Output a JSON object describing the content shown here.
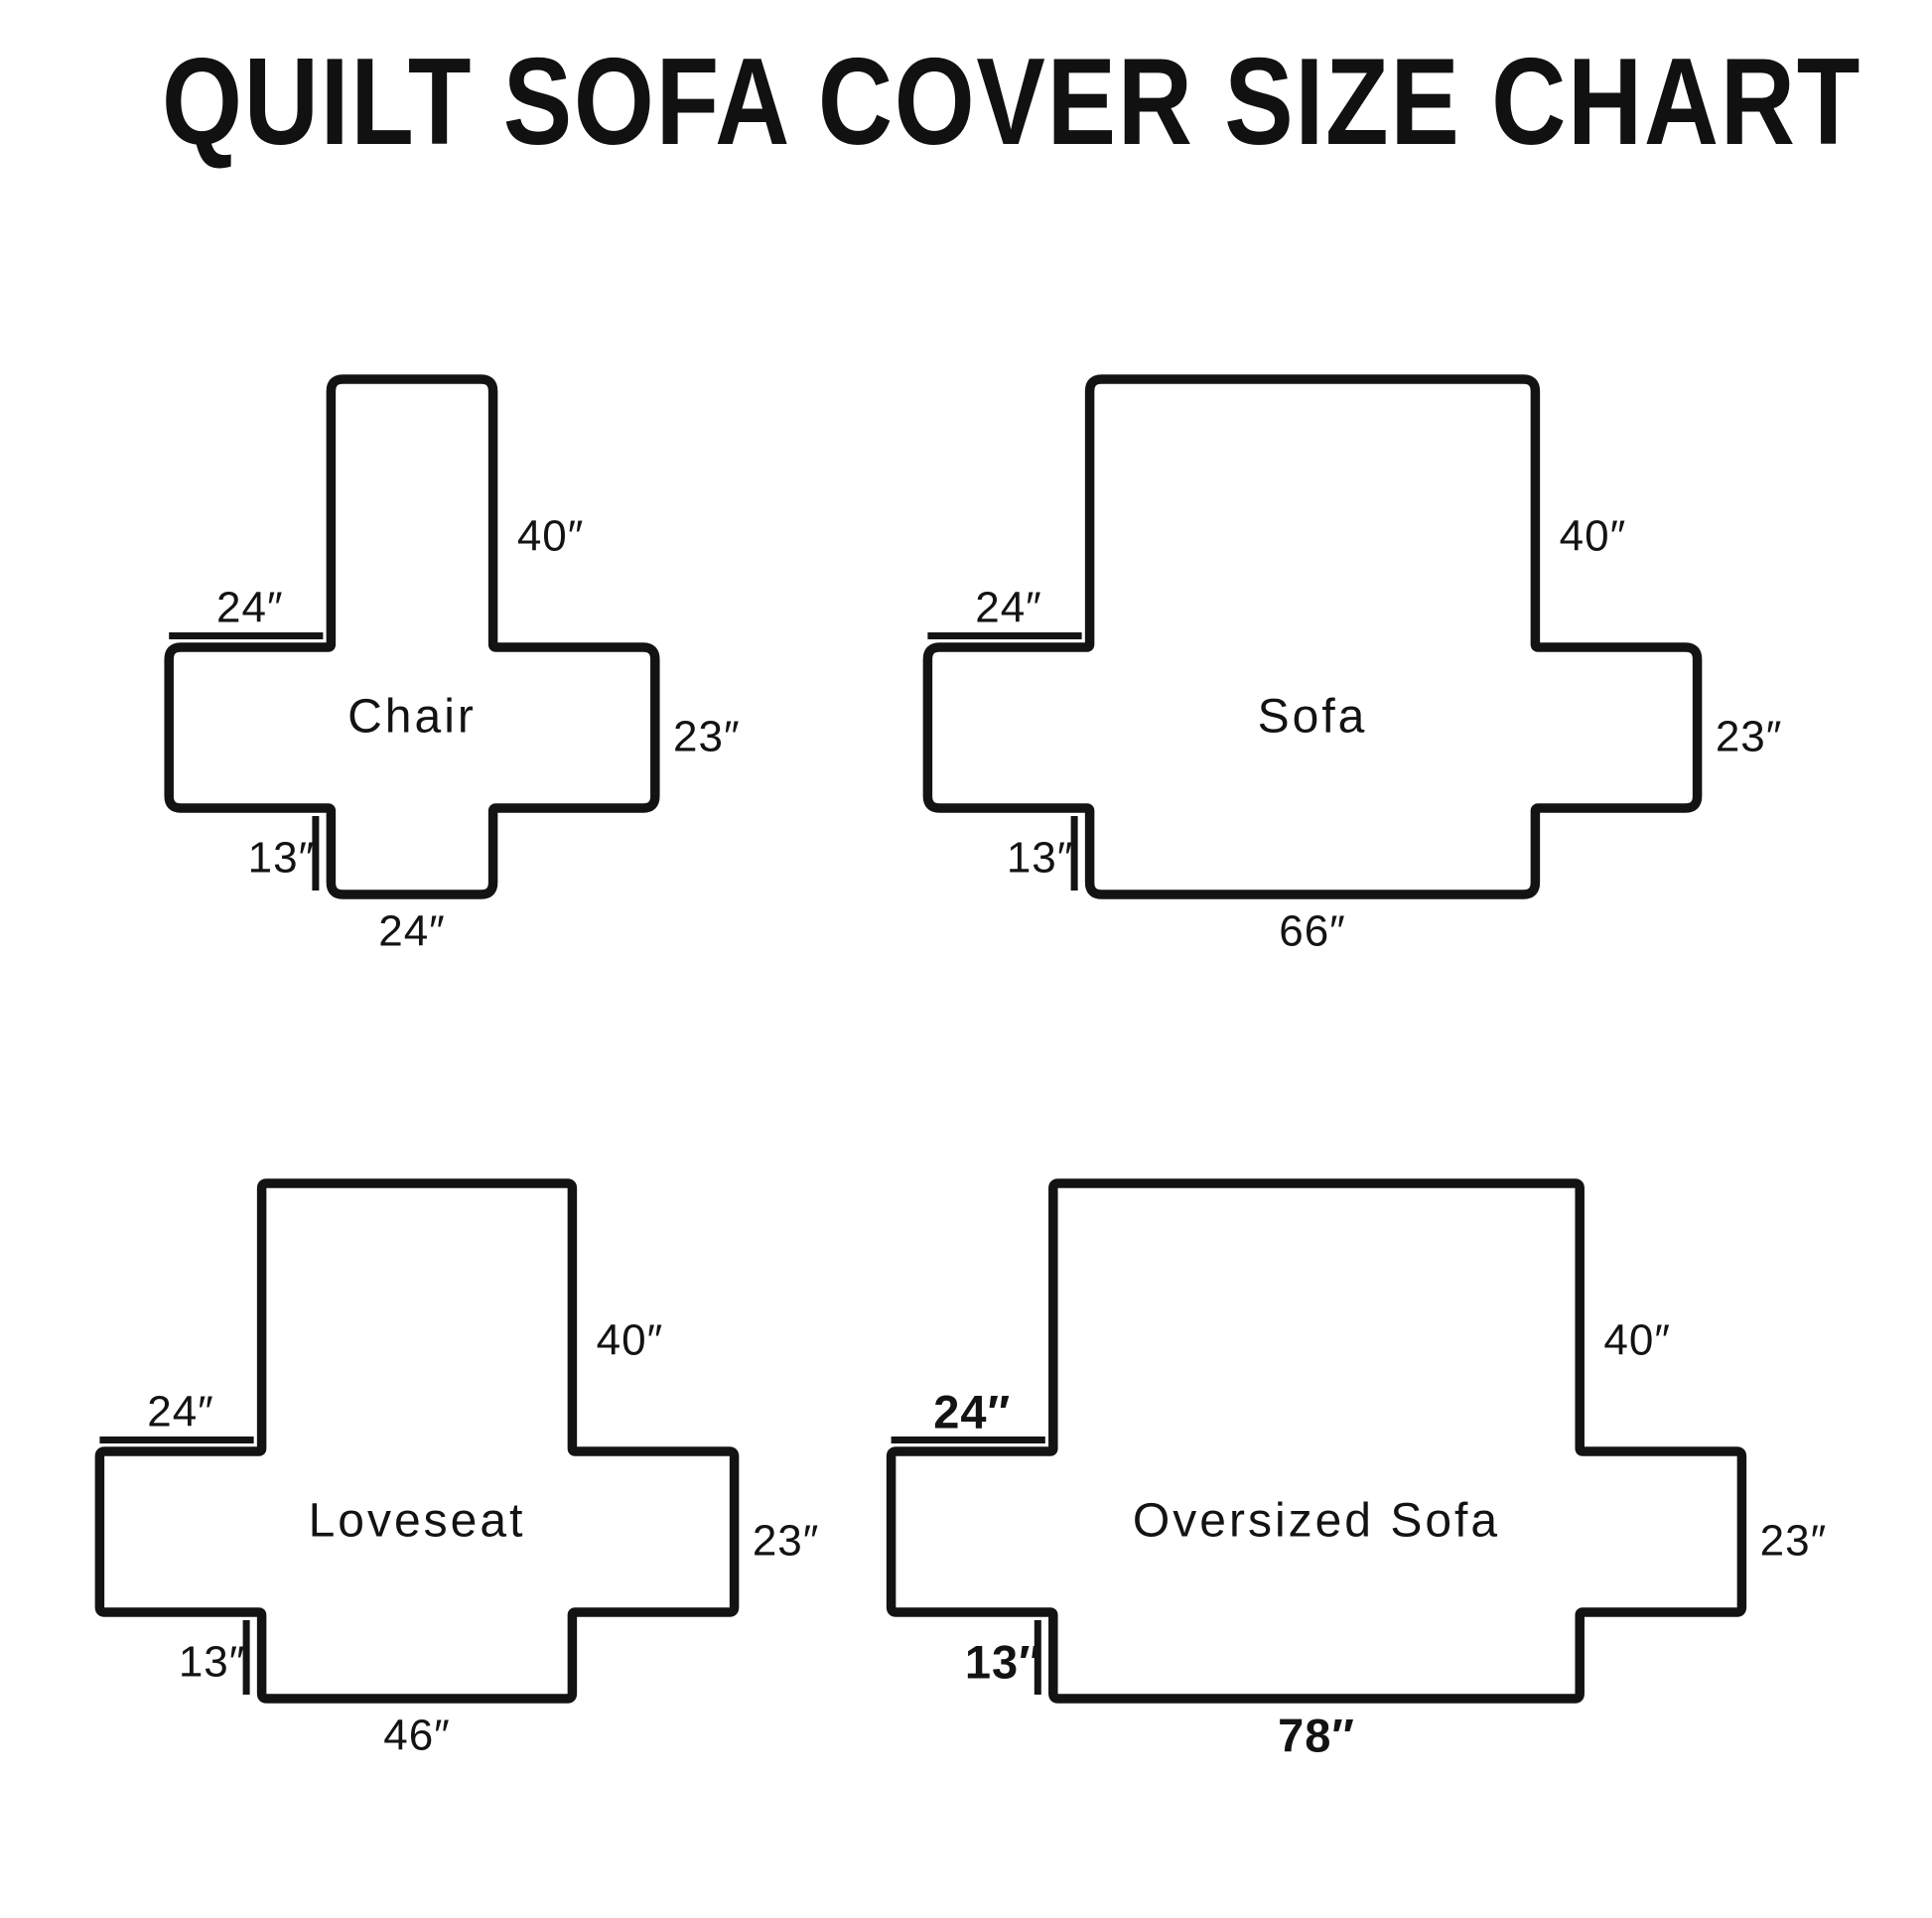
{
  "title": "QUILT SOFA COVER SIZE CHART",
  "unit_mark": "″",
  "colors": {
    "ink": "#131313",
    "background": "#ffffff"
  },
  "diagrams": [
    {
      "id": "chair",
      "name": "Chair",
      "back_height_label": "40″",
      "arm_depth_label": "24″",
      "arm_height_label": "23″",
      "flap_height_label": "13″",
      "bottom_width_label": "24″",
      "back_height_in": 40,
      "arm_depth_in": 24,
      "arm_height_in": 23,
      "flap_height_in": 13,
      "back_width_in": 24,
      "emphasized_dim_labels": false
    },
    {
      "id": "sofa",
      "name": "Sofa",
      "back_height_label": "40″",
      "arm_depth_label": "24″",
      "arm_height_label": "23″",
      "flap_height_label": "13″",
      "bottom_width_label": "66″",
      "back_height_in": 40,
      "arm_depth_in": 24,
      "arm_height_in": 23,
      "flap_height_in": 13,
      "back_width_in": 66,
      "emphasized_dim_labels": false
    },
    {
      "id": "loveseat",
      "name": "Loveseat",
      "back_height_label": "40″",
      "arm_depth_label": "24″",
      "arm_height_label": "23″",
      "flap_height_label": "13″",
      "bottom_width_label": "46″",
      "back_height_in": 40,
      "arm_depth_in": 24,
      "arm_height_in": 23,
      "flap_height_in": 13,
      "back_width_in": 46,
      "emphasized_dim_labels": false
    },
    {
      "id": "oversized-sofa",
      "name": "Oversized Sofa",
      "back_height_label": "40″",
      "arm_depth_label": "24″",
      "arm_height_label": "23″",
      "flap_height_label": "13″",
      "bottom_width_label": "78″",
      "back_height_in": 40,
      "arm_depth_in": 24,
      "arm_height_in": 23,
      "flap_height_in": 13,
      "back_width_in": 78,
      "emphasized_dim_labels": true
    }
  ]
}
